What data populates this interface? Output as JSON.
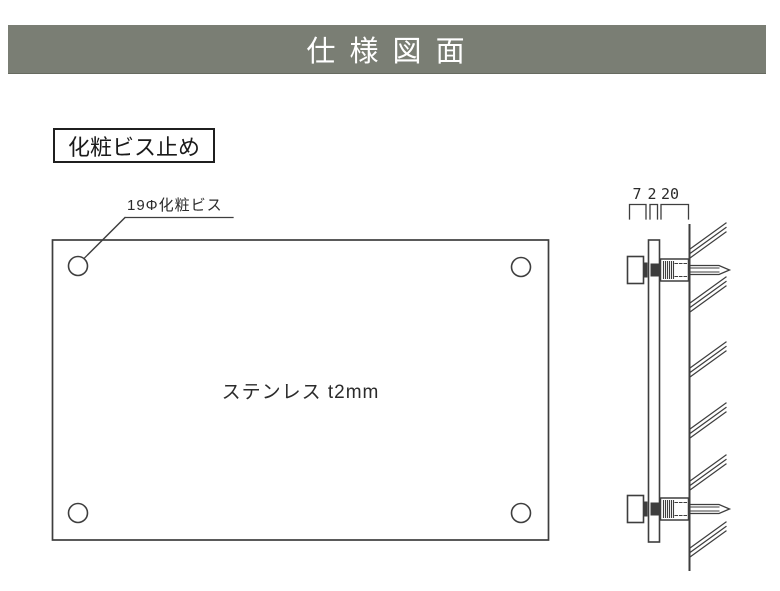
{
  "header": {
    "title": "仕 様 図 面",
    "background_color": "#7a7e74",
    "text_color": "#ffffff"
  },
  "labels": {
    "mounting_method": "化粧ビス止め",
    "screw_callout": "19Φ化粧ビス",
    "material": "ステンレス t2mm"
  },
  "side_view": {
    "dimension_labels": [
      "7",
      "2",
      "20"
    ]
  },
  "colors": {
    "line": "#3e3e3e",
    "header_bar": "#7a7e74"
  }
}
